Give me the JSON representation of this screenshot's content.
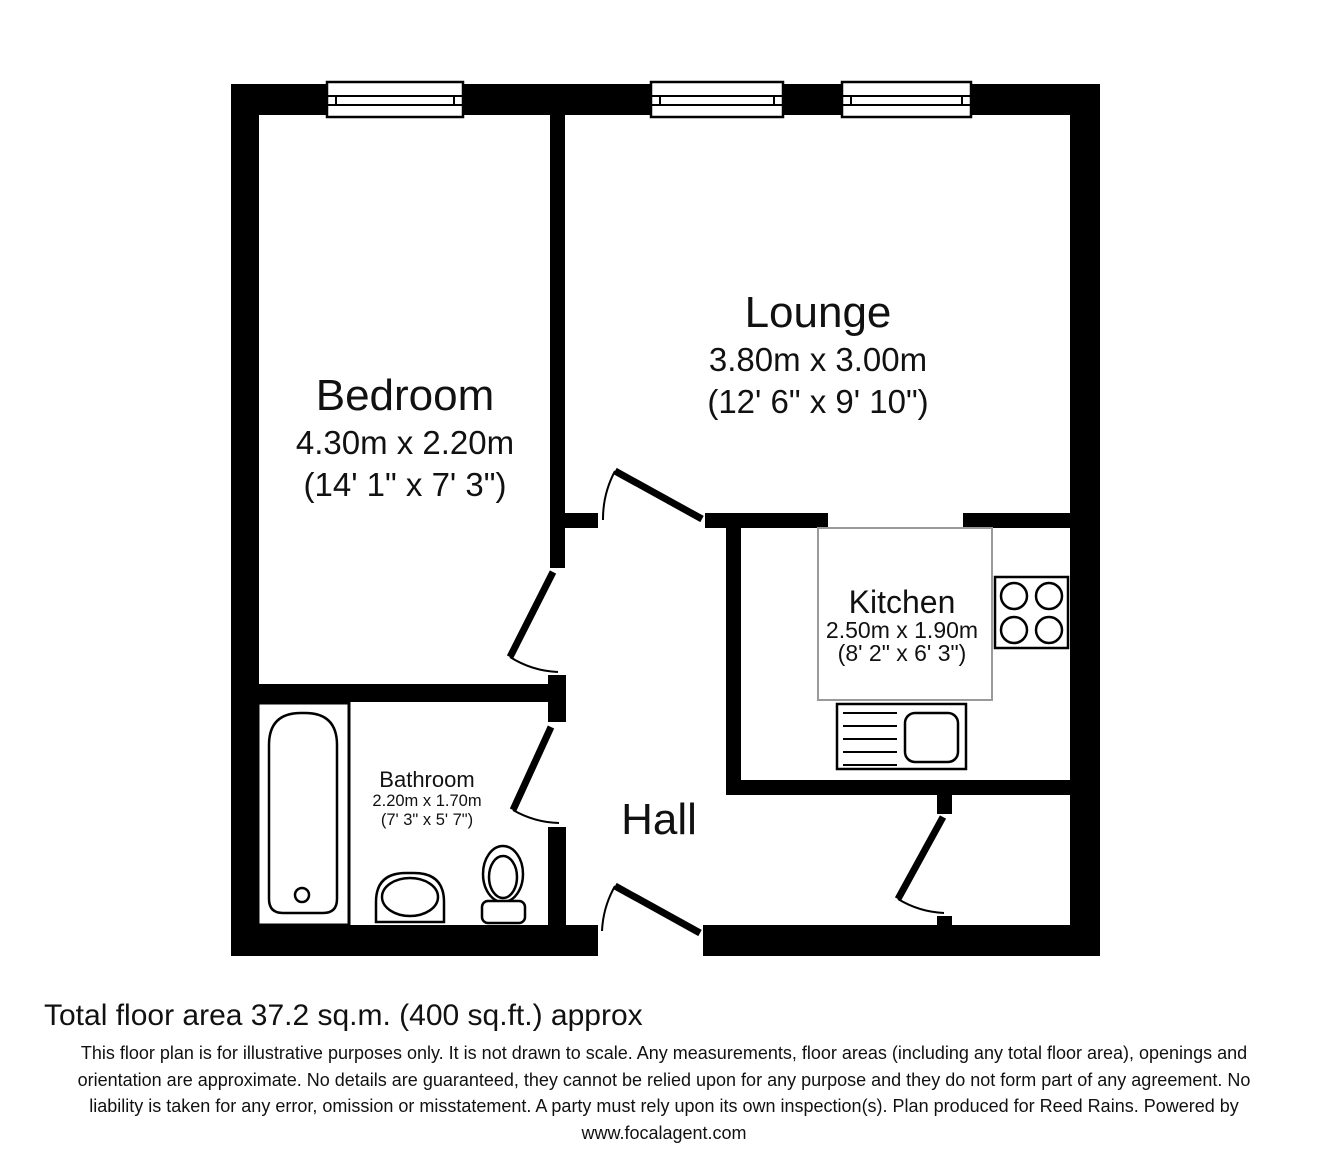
{
  "plan": {
    "rooms": [
      {
        "name": "Bedroom",
        "metric": "4.30m x 2.20m",
        "imperial": "(14' 1\" x 7' 3\")"
      },
      {
        "name": "Lounge",
        "metric": "3.80m x 3.00m",
        "imperial": "(12' 6\" x 9' 10\")"
      },
      {
        "name": "Kitchen",
        "metric": "2.50m x 1.90m",
        "imperial": "(8' 2\" x 6' 3\")"
      },
      {
        "name": "Bathroom",
        "metric": "2.20m x 1.70m",
        "imperial": "(7' 3\" x 5' 7\")"
      },
      {
        "name": "Hall",
        "metric": "",
        "imperial": ""
      }
    ]
  },
  "footer": {
    "total_area": "Total floor area 37.2 sq.m. (400 sq.ft.) approx",
    "disclaimer_lines": [
      "This floor plan is for illustrative purposes only. It is not drawn to scale. Any measurements, floor areas (including any total floor area), openings and",
      "orientation are approximate. No details are guaranteed, they cannot be relied upon for any purpose and they do not form part of any agreement. No",
      "liability is taken for any error, omission or misstatement. A party must rely upon its own inspection(s). Plan produced for Reed Rains. Powered by",
      "www.focalagent.com"
    ]
  },
  "colors": {
    "wall": "#000000",
    "background": "#ffffff",
    "counter_outline": "#9a9a9a"
  }
}
